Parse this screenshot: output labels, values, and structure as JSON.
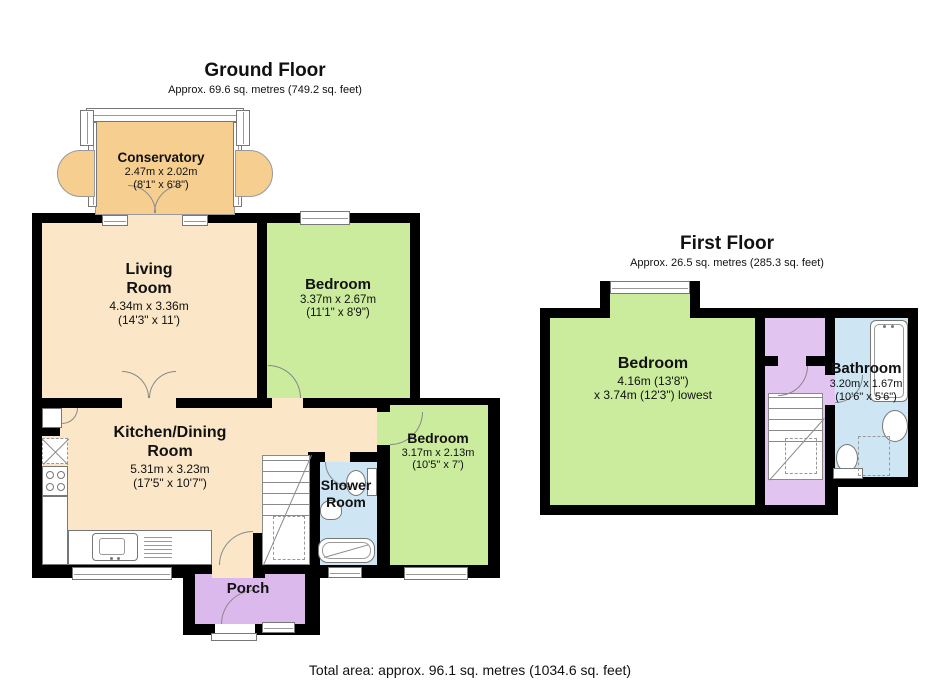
{
  "colors": {
    "wall": "#000000",
    "floor_beige": "#FBE7C7",
    "conservatory_orange": "#F6CE8F",
    "bedroom_green": "#CBEB9D",
    "bath_blue": "#CEE5F4",
    "porch_purple": "#DCB9ED",
    "landing_purple": "#E2C4F0"
  },
  "ground_floor": {
    "title": "Ground Floor",
    "subtitle": "Approx. 69.6 sq. metres (749.2 sq. feet)",
    "conservatory": {
      "name": "Conservatory",
      "size_m": "2.47m x 2.02m",
      "size_ft": "(8'1\" x 6'8\")"
    },
    "living_room": {
      "name1": "Living",
      "name2": "Room",
      "size_m": "4.34m x 3.36m",
      "size_ft": "(14'3\" x 11')"
    },
    "bedroom1": {
      "name": "Bedroom",
      "size_m": "3.37m x 2.67m",
      "size_ft": "(11'1\" x 8'9\")"
    },
    "kitchen": {
      "name1": "Kitchen/Dining",
      "name2": "Room",
      "size_m": "5.31m x 3.23m",
      "size_ft": "(17'5\" x 10'7\")"
    },
    "bedroom2": {
      "name": "Bedroom",
      "size_m": "3.17m x 2.13m",
      "size_ft": "(10'5\" x 7')"
    },
    "shower_room": {
      "name1": "Shower",
      "name2": "Room"
    },
    "porch": {
      "name": "Porch"
    }
  },
  "first_floor": {
    "title": "First Floor",
    "subtitle": "Approx. 26.5 sq. metres (285.3 sq. feet)",
    "bedroom": {
      "name": "Bedroom",
      "size_line1": "4.16m (13'8\")",
      "size_line2": "x 3.74m (12'3\") lowest"
    },
    "bathroom": {
      "name": "Bathroom",
      "size_m": "3.20m x 1.67m",
      "size_ft": "(10'6\" x 5'6\")"
    }
  },
  "footer": {
    "total_area": "Total area: approx. 96.1 sq. metres (1034.6 sq. feet)"
  }
}
